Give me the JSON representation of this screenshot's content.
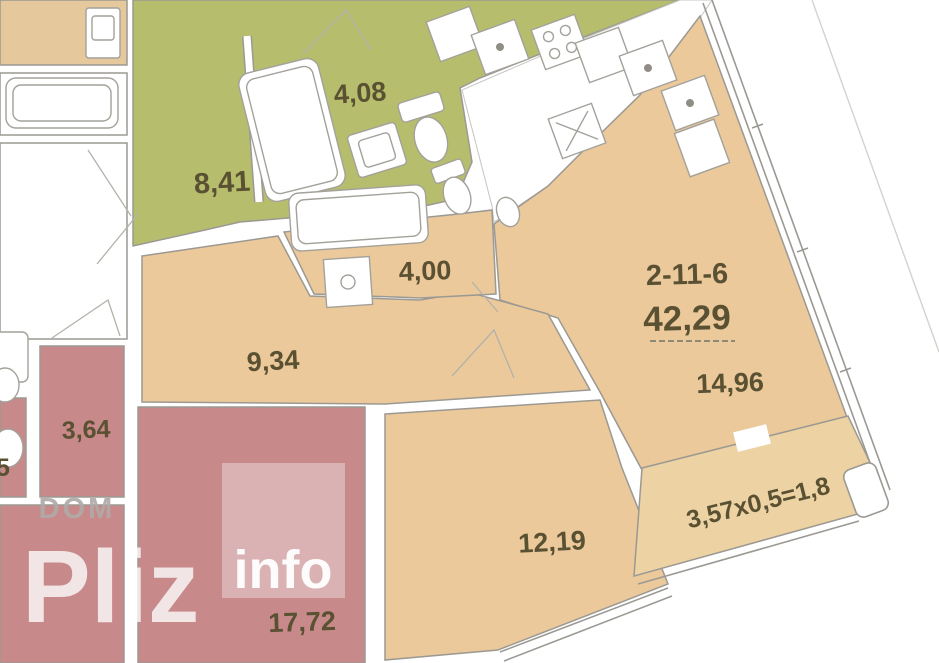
{
  "apartment": {
    "number": "2-11-6",
    "total_area": "42,29"
  },
  "rooms": {
    "hallway": "8,41",
    "bathroom_small": "4,08",
    "bathroom": "4,00",
    "corridor": "9,34",
    "closet": "3,64",
    "living": "14,96",
    "bedroom": "12,19",
    "neighbor_room": "17,72",
    "neighbor_partial": "5",
    "balcony_formula": "3,57x0,5=1,8"
  },
  "watermark": {
    "word1": "DOM",
    "word2": "Pliz",
    "word3": "info"
  },
  "colors": {
    "green": "#b6be6d",
    "beige": "#ebc99b",
    "beige_light": "#edd2a4",
    "pink": "#c8898a",
    "neighbor_beige": "#e5c89c",
    "wall_outline": "#9b9992",
    "label_text": "#5a5133",
    "watermark_gray": "#b0aba8"
  }
}
